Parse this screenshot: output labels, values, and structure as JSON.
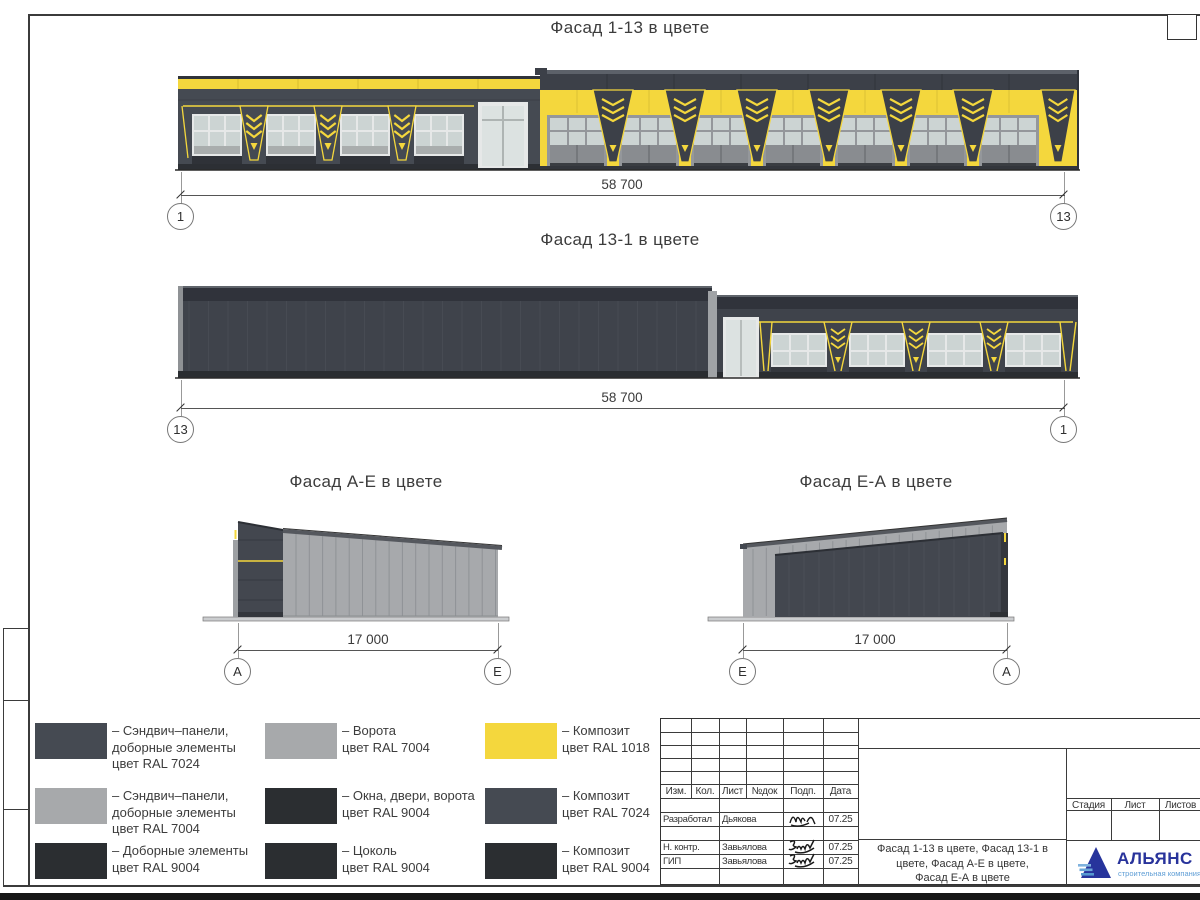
{
  "colors": {
    "ral1018": "#f4d73d",
    "ral7024": "#454a52",
    "ral7004": "#a7a9ab",
    "ral9004": "#2b2e31",
    "glass": "#ccd4d3",
    "frame_light": "#e6e8e8",
    "door_gray": "#94979b",
    "roof_band": "#3c4048",
    "dark_edge": "#2f333a",
    "plinth": "#2c2f34",
    "ground": "#2a2a2a",
    "panel_light": "#a7a9ac"
  },
  "facades": {
    "top": {
      "title": "Фасад 1-13 в цвете",
      "dim": "58 700",
      "marker_left": "1",
      "marker_right": "13",
      "left_window_bays": 4,
      "right_door_bays": 7
    },
    "back": {
      "title": "Фасад 13-1 в цвете",
      "dim": "58 700",
      "marker_left": "13",
      "marker_right": "1",
      "window_bays": 4
    },
    "ae": {
      "title": "Фасад А-Е в цвете",
      "dim": "17 000",
      "marker_left": "А",
      "marker_right": "Е"
    },
    "ea": {
      "title": "Фасад Е-А в цвете",
      "dim": "17 000",
      "marker_left": "Е",
      "marker_right": "А"
    }
  },
  "legend": {
    "items": [
      {
        "color": "#454a52",
        "label": "– Сэндвич–панели,\nдоборные элементы\nцвет RAL 7024"
      },
      {
        "color": "#a7a9ab",
        "label": "– Ворота\nцвет RAL 7004"
      },
      {
        "color": "#f4d73d",
        "label": "– Композит\nцвет RAL 1018"
      },
      {
        "color": "#a7a9ab",
        "label": "– Сэндвич–панели,\nдоборные элементы\nцвет RAL 7004"
      },
      {
        "color": "#2b2e31",
        "label": "– Окна, двери, ворота\nцвет RAL 9004"
      },
      {
        "color": "#454a52",
        "label": "– Композит\nцвет RAL 7024"
      },
      {
        "color": "#2b2e31",
        "label": "– Доборные элементы\nцвет RAL 9004"
      },
      {
        "color": "#2b2e31",
        "label": "– Цоколь\nцвет RAL 9004"
      },
      {
        "color": "#2b2e31",
        "label": "– Композит\nцвет RAL 9004"
      }
    ]
  },
  "stamp": {
    "header_cols": [
      "Изм.",
      "Кол.",
      "Лист",
      "№док",
      "Подп.",
      "Дата"
    ],
    "rows": [
      {
        "role": "Разработал",
        "name": "Дьякова",
        "date": "07.25"
      },
      {
        "role": "Н. контр.",
        "name": "Завьялова",
        "date": "07.25"
      },
      {
        "role": "ГИП",
        "name": "Завьялова",
        "date": "07.25"
      }
    ],
    "doc_title": "Фасад 1-13 в цвете, Фасад 13-1 в\nцвете, Фасад А-Е в цвете,\nФасад Е-А в цвете",
    "right_cols": [
      "Стадия",
      "Лист",
      "Листов"
    ],
    "logo": {
      "name": "АЛЬЯНС",
      "subtitle": "строительная компания"
    }
  }
}
